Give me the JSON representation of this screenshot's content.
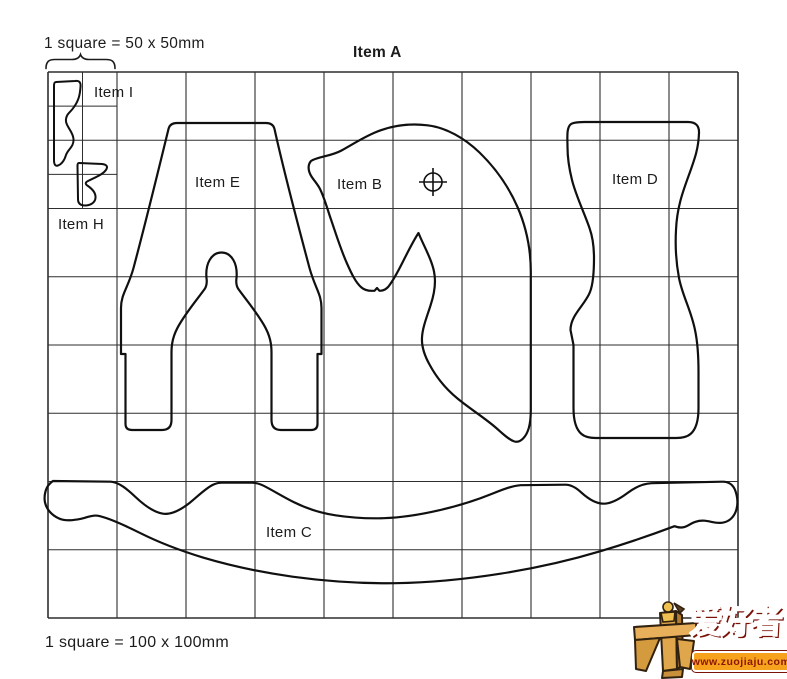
{
  "diagram": {
    "title": "Item A",
    "scale_note_small": "1 square = 50 x 50mm",
    "scale_note_large": "1 square = 100 x 100mm",
    "grid": {
      "columns": 10,
      "rows": 8,
      "small_grid_columns": 2,
      "small_grid_rows": 4,
      "large_square_mm": "100 x 100",
      "small_square_mm": "50 x 50",
      "line_color": "#2e2e2e"
    },
    "labels": {
      "item_i": "Item I",
      "item_h": "Item H",
      "item_e": "Item E",
      "item_b": "Item B",
      "item_d": "Item D",
      "item_c": "Item C"
    },
    "icons": {
      "pivot_mark": "crosshair-circle"
    },
    "outline_color": "#101010"
  },
  "watermark": {
    "brand_text": "爱好者",
    "site_url": "www.zuojiaju.com",
    "colors": {
      "banner": "#f6a21c",
      "brand_red": "#c32017",
      "wood": "#dfa64b"
    }
  }
}
